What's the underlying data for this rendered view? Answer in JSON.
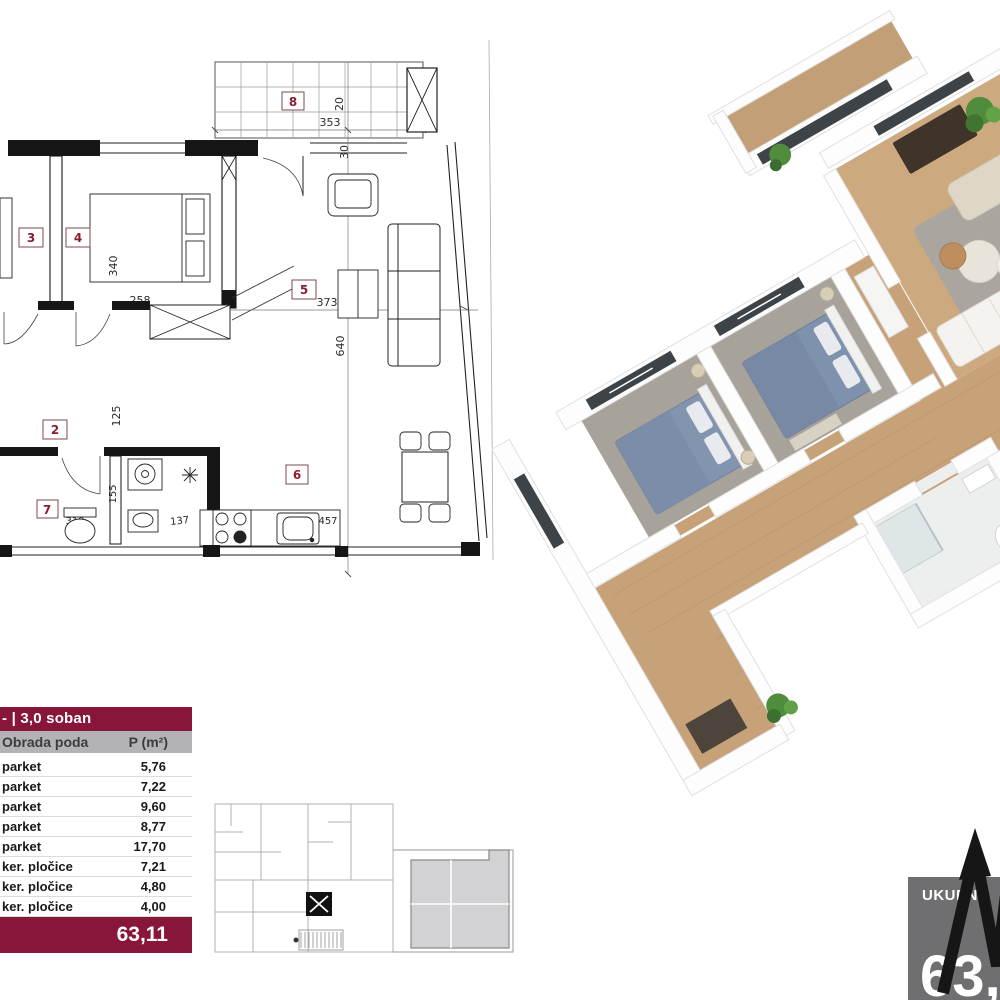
{
  "window": {
    "background": "#ffffff"
  },
  "floorplan2d": {
    "labels": {
      "r2": "2",
      "r3": "3",
      "r4": "4",
      "r5": "5",
      "r6": "6",
      "r7": "7",
      "r8": "8"
    },
    "dims": {
      "balcony_353": "353",
      "balcony_20": "20",
      "balcony_30": "30",
      "r4_340": "340",
      "r4_258": "258",
      "l5_373": "373",
      "l5_640": "640",
      "hall_125": "125",
      "wc_155": "155",
      "wc_310": "310",
      "k_137": "137",
      "k_457": "457"
    },
    "line_color": "#1c1c1c",
    "label_color": "#8b1e2d"
  },
  "area_table": {
    "title": "- | 3,0 soban",
    "columns": {
      "finish": "Obrada poda",
      "area": "P (m²)"
    },
    "rows": [
      {
        "finish": "parket",
        "area": "5,76"
      },
      {
        "finish": "parket",
        "area": "7,22"
      },
      {
        "finish": "parket",
        "area": "9,60"
      },
      {
        "finish": "parket",
        "area": "8,77"
      },
      {
        "finish": "parket",
        "area": "17,70"
      },
      {
        "finish": "ker. pločice",
        "area": "7,21"
      },
      {
        "finish": "ker. pločice",
        "area": "4,80"
      },
      {
        "finish": "ker. pločice",
        "area": "4,00"
      }
    ],
    "total": "63,11",
    "header_bg": "#871638",
    "subheader_bg": "#b3b2b4"
  },
  "summary_box": {
    "label": "UKUPNO",
    "value": "63,11",
    "bg": "#6f6e71"
  },
  "north_arrow": {
    "letter": "N"
  },
  "site_plan": {
    "highlight_color": "#d2d1d3"
  },
  "render3d": {
    "floor_wood": "#c7a178",
    "carpet": "#a7a29a",
    "bed_blue": "#8294ae",
    "window_dark": "#3e4348",
    "plant_green": "#4f8c3c",
    "rug_gray": "#aaa69f",
    "bath_tile": "#edefef",
    "mat_dark": "#4d453c"
  }
}
